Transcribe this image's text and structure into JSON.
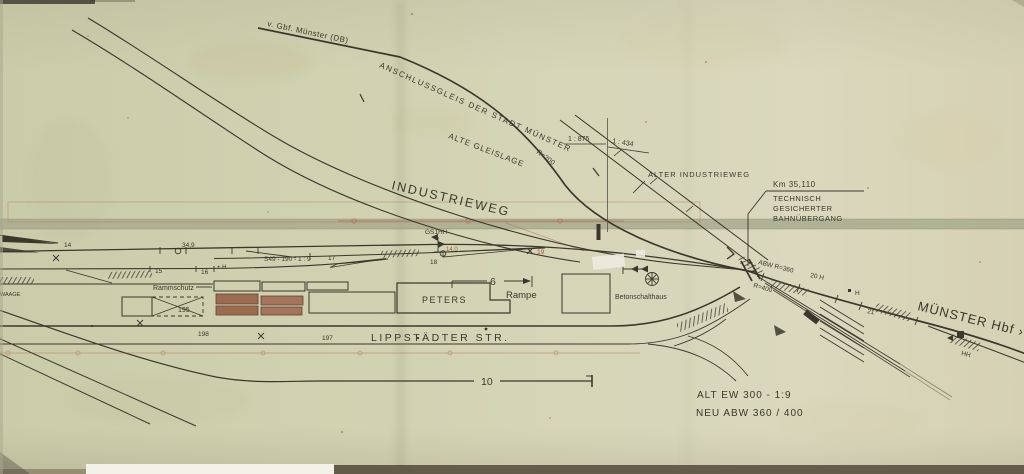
{
  "labels": {
    "from_gbf": "v. Gbf. Münster (DB)",
    "anschlussgleis": "ANSCHLUSSGLEIS  DER  STADT  MÜNSTER",
    "alte_gleislage": "ALTE  GLEISLAGE",
    "radius_200": "R=200",
    "gradient_left": "1 : 875",
    "gradient_right": "1 : 434",
    "alter_industrieweg": "ALTER   INDUSTRIEWEG",
    "km_mark": "Km  35,110",
    "bue_line1": "TECHNISCH",
    "bue_line2": "GESICHERTER",
    "bue_line3": "BAHNÜBERGANG",
    "industrieweg": "INDUSTRIEWEG",
    "turnout_spec": "S49 - 190 - 1 : 9",
    "signal_gs1hh": "GS1HH",
    "rammschutz": "Rammschutz",
    "peters": "PETERS",
    "rampe": "Rampe",
    "betonschalthaus": "Betonschalthaus",
    "lippstaedter_str": "LIPPSTÄDTER  STR.",
    "muenster_hbf": "MÜNSTER Hbf  ›",
    "abw_radius": "ABW  R=360",
    "radius_400": "R=400",
    "h20": "20  H",
    "plus_h": "+ H",
    "h_right": "H",
    "hh": "HH",
    "note_alt": "ALT   EW  300 - 1:9",
    "note_neu": "NEU   ABW  360 / 400",
    "waage": "WAAGE"
  },
  "numbers": {
    "n14": "14",
    "n34_9": "34,9",
    "n15": "15",
    "n16": "16",
    "n17": "17",
    "n18": "18",
    "n14_0": "14,0",
    "n19": "19",
    "n21": "21",
    "n195": "195",
    "n197": "197",
    "n198": "198",
    "n10": "10",
    "n6": "6"
  },
  "colors": {
    "paper": "#d2d3b4",
    "ink": "#3a382c",
    "accent_red": "#a5593f",
    "band_olive": "#a9ac8e",
    "building_brown": "#9c6b50"
  }
}
